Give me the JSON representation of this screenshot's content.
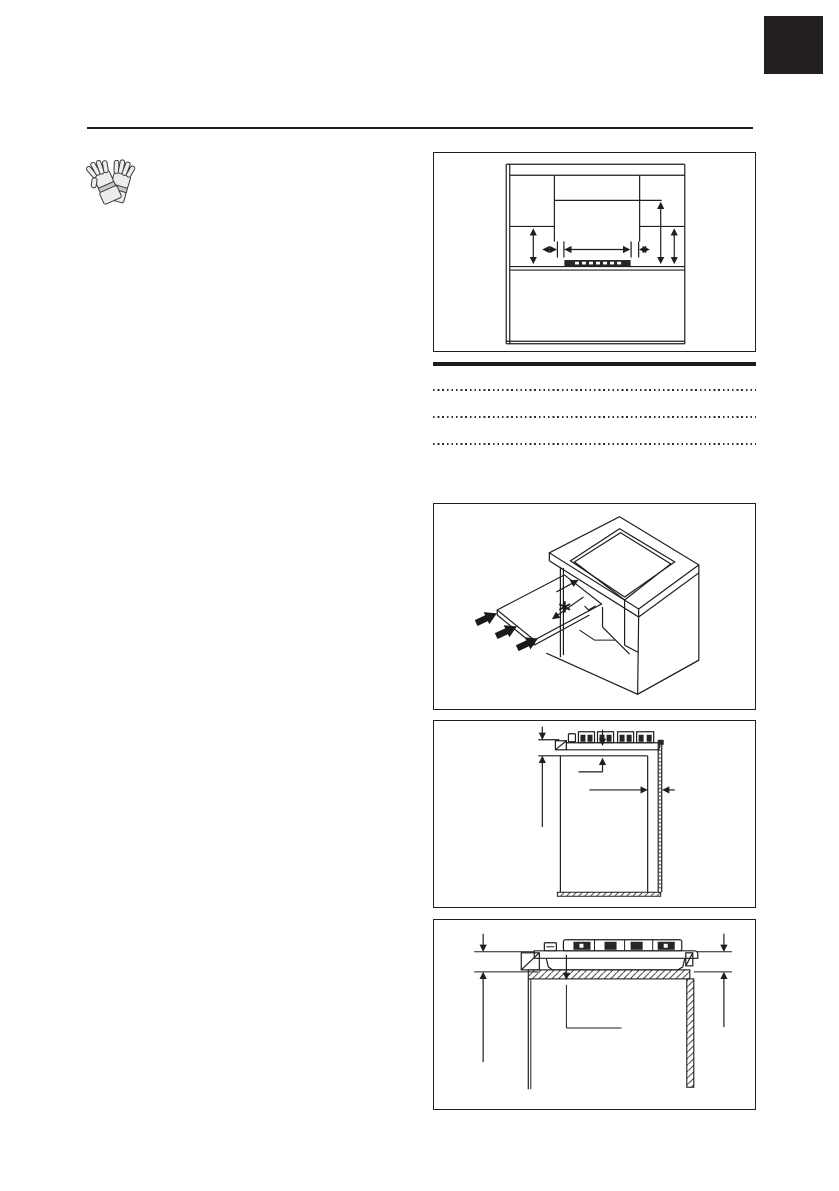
{
  "page": {
    "background": "#ffffff",
    "ink_color": "#1f1f1f",
    "corner_tab_color": "#231f20"
  },
  "safety": {
    "icon": "protective-gloves-icon"
  },
  "figures": [
    {
      "name": "front-clearances-diagram",
      "annotation": ""
    },
    {
      "name": "shelf-insertion-3d-diagram",
      "annotation": "*"
    },
    {
      "name": "cabinet-section-diagram",
      "annotation": ""
    },
    {
      "name": "worktop-seal-section-diagram",
      "annotation": ""
    }
  ],
  "write_in_lines": {
    "count": 3,
    "style": "dotted"
  }
}
